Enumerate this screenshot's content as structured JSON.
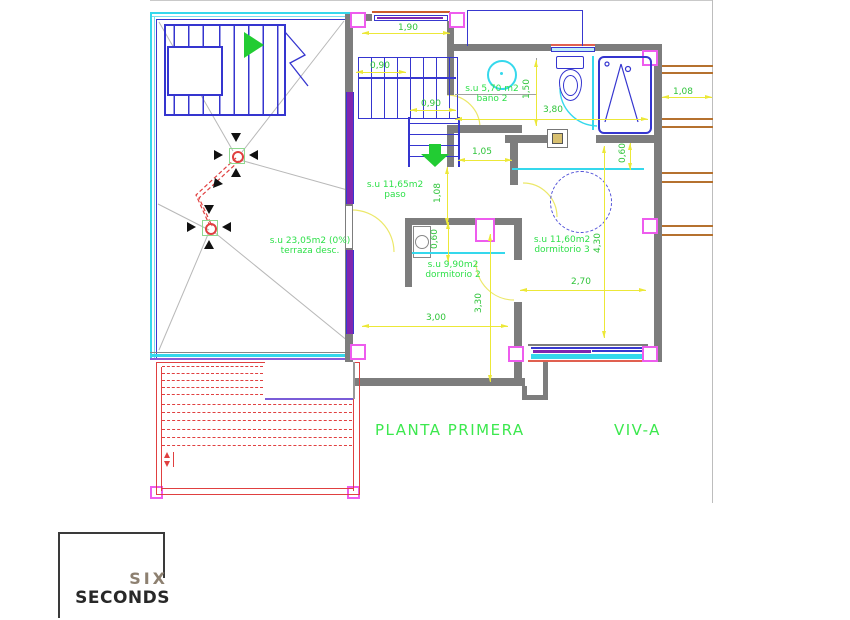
{
  "titles": {
    "plan_title": "PLANTA PRIMERA",
    "unit_label": "VIV-A"
  },
  "rooms": {
    "terraza": {
      "area": "s.u 23,05m2 (0%)",
      "name": "terraza desc."
    },
    "paso": {
      "area": "s.u 11,65m2",
      "name": "paso"
    },
    "bano2": {
      "area": "s.u 5,70 m2",
      "name": "baño 2"
    },
    "dormitorio2": {
      "area": "s.u 9,90m2",
      "name": "dormitorio 2"
    },
    "dormitorio3": {
      "area": "s.u 11,60m2",
      "name": "dormitorio 3"
    }
  },
  "dimensions": [
    "1,90",
    "0,90",
    "0,90",
    "1,05",
    "1,08",
    "1,50",
    "3,80",
    "0,60",
    "1,08",
    "0,60",
    "3,30",
    "3,00",
    "4,30",
    "2,70"
  ],
  "logo": {
    "line1": "SIX",
    "line2": "SECONDS"
  },
  "colors": {
    "label_green": "#2fe04a",
    "dimension_green": "#2fc43a",
    "dimension_yellow": "#ece838",
    "wall_gray": "#7d7d7d",
    "stair_blue": "#3535cf",
    "window_cyan": "#35d8ec",
    "glazing_purple": "#8026b0",
    "column_pink": "#ee5cee",
    "below_roof_red": "#e04040",
    "pergola_orange": "#b5712f",
    "arrow_green": "#22cc33"
  }
}
